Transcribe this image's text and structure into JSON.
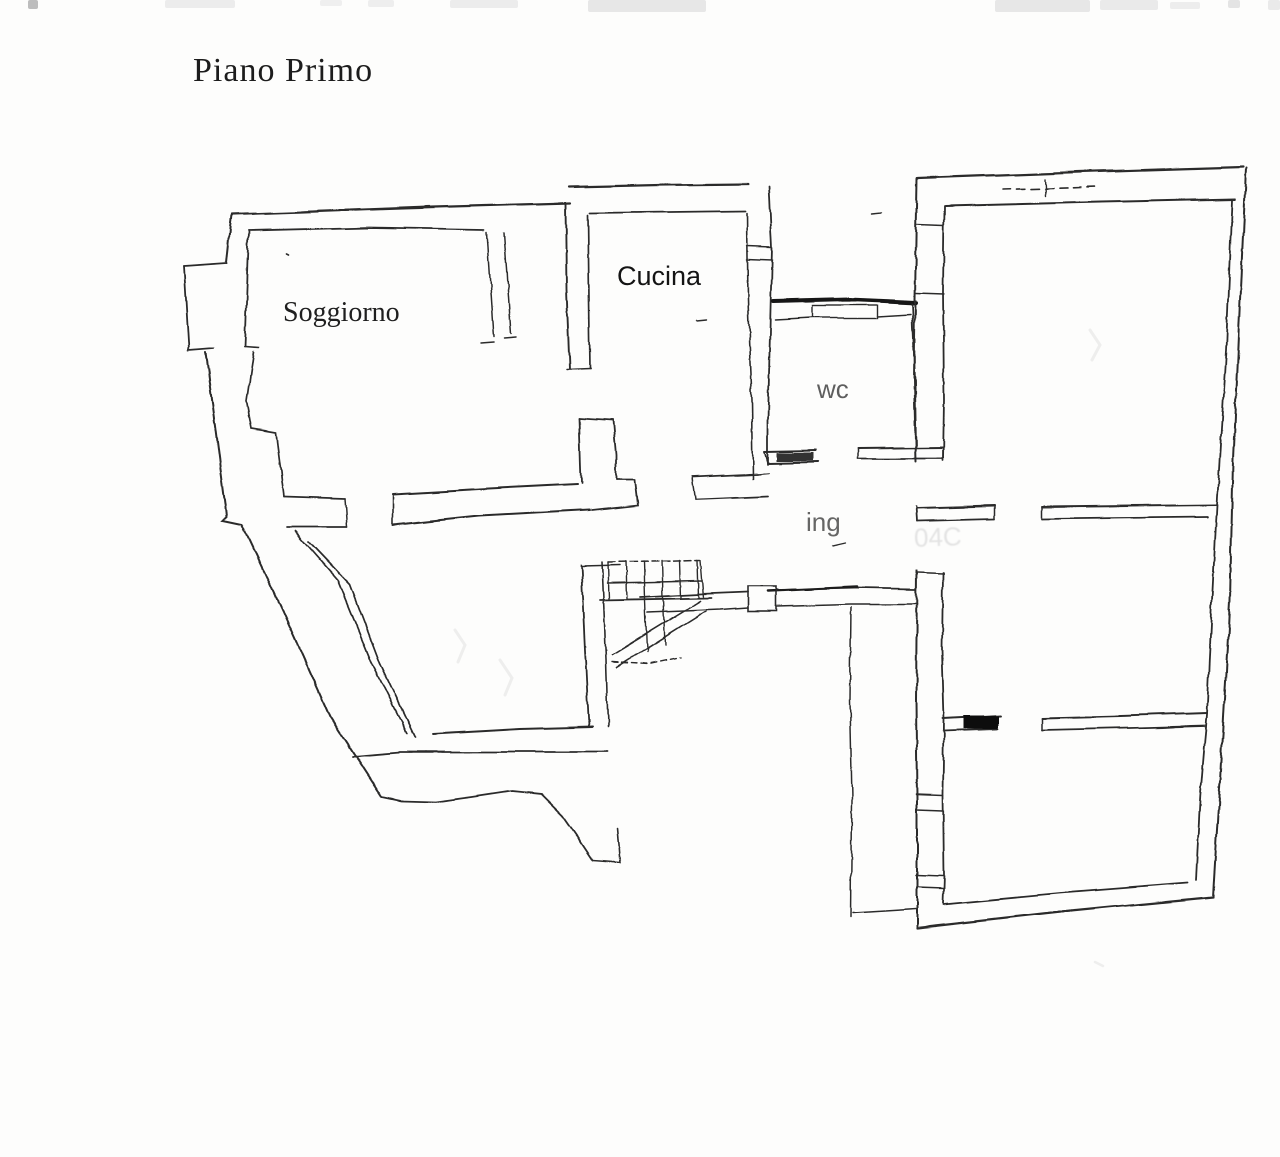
{
  "title": {
    "text": "Piano Primo",
    "x": 193,
    "y": 52,
    "size": 34,
    "color": "#1c1c1c"
  },
  "labels": {
    "soggiorno": {
      "text": "Soggiorno",
      "x": 283,
      "y": 299,
      "size": 28,
      "kind": "serif",
      "color": "#1f1f1f",
      "faded": false
    },
    "cucina": {
      "text": "Cucina",
      "x": 617,
      "y": 263,
      "size": 27,
      "kind": "sans",
      "color": "#141414",
      "faded": false
    },
    "wc": {
      "text": "wc",
      "x": 817,
      "y": 376,
      "size": 26,
      "kind": "sans",
      "color": "#3c3c3c",
      "faded": true
    },
    "ing": {
      "text": "ing",
      "x": 806,
      "y": 509,
      "size": 26,
      "kind": "sans",
      "color": "#454545",
      "faded": true
    }
  },
  "ghost_text": {
    "text": "04C",
    "x": 914,
    "y": 522,
    "size": 26
  },
  "floorplan": {
    "stroke": "#2c2c2c",
    "paths": [
      {
        "p": "232,214 400,208 570,203",
        "w": 2.2
      },
      {
        "p": "300,211 430,206",
        "w": 1.2
      },
      {
        "p": "232,214 227,263",
        "w": 2
      },
      {
        "p": "227,263 184,266",
        "w": 1.8
      },
      {
        "p": "184,266 189,350",
        "w": 1.8
      },
      {
        "p": "189,350 214,348",
        "w": 1.8
      },
      {
        "p": "206,352 227,516 223,520 242,524 283,612 330,717 382,797",
        "w": 2
      },
      {
        "p": "382,797 401,801 435,802 472,797 512,791 541,794 563,816 579,839 593,860",
        "w": 1.8
      },
      {
        "p": "593,860 620,862 617,828",
        "w": 1.6
      },
      {
        "p": "249,231 370,228 484,230",
        "w": 1.8
      },
      {
        "p": "249,231 245,347",
        "w": 1.8
      },
      {
        "p": "245,347 259,348",
        "w": 1.6
      },
      {
        "p": "254,352 247,401 252,429 276,433 284,496",
        "w": 1.7
      },
      {
        "p": "284,496 345,498",
        "w": 1.7
      },
      {
        "p": "286,527 347,527",
        "w": 1.7
      },
      {
        "p": "345,498 347,527",
        "w": 1.5
      },
      {
        "p": "295,531 338,580 371,661 407,733",
        "w": 1.7
      },
      {
        "p": "309,541 350,584 380,663 415,737",
        "w": 1.7
      },
      {
        "p": "433,734 520,729 593,727",
        "w": 1.9
      },
      {
        "p": "352,756 400,752 500,752 608,752",
        "w": 1.8
      },
      {
        "p": "393,494 480,489 577,484",
        "w": 2
      },
      {
        "p": "393,525 480,516 590,510",
        "w": 2
      },
      {
        "p": "393,494 393,525",
        "w": 1.6
      },
      {
        "p": "487,232 494,337",
        "w": 1.5
      },
      {
        "p": "504,232 511,334",
        "w": 1.5
      },
      {
        "p": "481,344 494,343",
        "w": 1.5
      },
      {
        "p": "504,339 516,338",
        "w": 1.5
      },
      {
        "p": "579,418 581,483",
        "w": 1.8
      },
      {
        "p": "579,418 613,420",
        "w": 1.8
      },
      {
        "p": "613,420 616,455 616,480",
        "w": 1.8
      },
      {
        "p": "616,480 634,480 637,505 592,510",
        "w": 1.8
      },
      {
        "p": "566,203 567,290 570,369",
        "w": 1.9
      },
      {
        "p": "588,215 589,300 590,368",
        "w": 1.7
      },
      {
        "p": "567,369 590,368",
        "w": 1.5
      },
      {
        "p": "568,187 660,185 748,184",
        "w": 2.2
      },
      {
        "p": "590,213 670,212 746,211",
        "w": 1.8
      },
      {
        "p": "769,186 772,247 770,330 768,420 768,464",
        "w": 1.8
      },
      {
        "p": "747,213 748,300 752,400 753,478",
        "w": 1.6
      },
      {
        "p": "747,246 772,247",
        "w": 1.5
      },
      {
        "p": "747,259 772,260",
        "w": 1.5
      },
      {
        "p": "692,477 757,474",
        "w": 1.8
      },
      {
        "p": "695,500 768,497",
        "w": 1.8
      },
      {
        "p": "692,477 695,500",
        "w": 1.5
      },
      {
        "p": "757,474 768,473",
        "w": 1.5
      },
      {
        "p": "773,301 850,299 916,302",
        "w": 4,
        "c": "#161616"
      },
      {
        "p": "775,320 812,318",
        "w": 1.5
      },
      {
        "p": "877,316 910,314",
        "w": 1.5
      },
      {
        "p": "912,303 915,380 916,448",
        "w": 1.8
      },
      {
        "p": "765,452 815,451",
        "w": 2
      },
      {
        "p": "768,463 818,462",
        "w": 2
      },
      {
        "p": "765,452 768,463",
        "w": 1.5
      },
      {
        "p": "858,448 943,447",
        "w": 2
      },
      {
        "p": "858,459 943,459",
        "w": 1.8
      },
      {
        "p": "858,448 858,459",
        "w": 1.5
      },
      {
        "p": "943,447 943,459",
        "w": 1.5
      },
      {
        "p": "640,597 700,594 748,592",
        "w": 1.8
      },
      {
        "p": "776,590 858,588 916,589",
        "w": 1.8
      },
      {
        "p": "648,612 720,609 748,607",
        "w": 1.6
      },
      {
        "p": "776,606 850,604 917,604",
        "w": 1.6
      },
      {
        "p": "768,591 856,587",
        "w": 2.6,
        "c": "#1d1d1d"
      },
      {
        "p": "608,562 700,560",
        "w": 1.5,
        "d": "7,4"
      },
      {
        "p": "608,583 702,581",
        "w": 1.5
      },
      {
        "p": "600,600 712,598",
        "w": 1.8
      },
      {
        "p": "626,561 627,599",
        "w": 1.4
      },
      {
        "p": "644,561 645,599",
        "w": 1.4
      },
      {
        "p": "662,560 663,598",
        "w": 1.4
      },
      {
        "p": "680,560 681,598",
        "w": 1.4
      },
      {
        "p": "698,560 699,598",
        "w": 1.4
      },
      {
        "p": "608,562 609,599",
        "w": 1.4
      },
      {
        "p": "701,560 704,598",
        "w": 1.4
      },
      {
        "p": "645,600 647,652",
        "w": 1.4
      },
      {
        "p": "663,599 665,645",
        "w": 1.4
      },
      {
        "p": "612,655 700,601",
        "w": 1.6
      },
      {
        "p": "617,667 706,611",
        "w": 1.6
      },
      {
        "p": "612,662 650,664 682,657",
        "w": 1.4,
        "d": "6,4"
      },
      {
        "p": "581,565 585,650 589,727",
        "w": 1.8
      },
      {
        "p": "602,562 606,660 608,726",
        "w": 1.6
      },
      {
        "p": "582,566 620,565",
        "w": 1.5
      },
      {
        "p": "918,178 1080,172 1243,167",
        "w": 2.2
      },
      {
        "p": "945,206 1100,202 1235,199",
        "w": 2
      },
      {
        "p": "917,178 915,300 914,380 916,462",
        "w": 2
      },
      {
        "p": "916,506 917,521",
        "w": 1.8
      },
      {
        "p": "917,571 916,700 917,800 917,928",
        "w": 2
      },
      {
        "p": "944,206 943,292 944,400 943,461",
        "w": 1.8
      },
      {
        "p": "917,225 944,226",
        "w": 1.5
      },
      {
        "p": "916,293 944,294",
        "w": 1.5
      },
      {
        "p": "1003,190 1097,187",
        "w": 1.6,
        "d": "8,6"
      },
      {
        "p": "1045,179 1046,196",
        "w": 1.4
      },
      {
        "p": "1232,200 1226,350 1217,505 1212,600 1207,715 1200,800 1196,880",
        "w": 1.8
      },
      {
        "p": "1246,168 1240,300 1233,460 1230,600 1220,780 1213,897",
        "w": 2
      },
      {
        "p": "917,508 995,506",
        "w": 1.9
      },
      {
        "p": "917,521 995,519",
        "w": 1.7
      },
      {
        "p": "995,506 995,519",
        "w": 1.5
      },
      {
        "p": "1042,507 1130,506 1216,505",
        "w": 1.9
      },
      {
        "p": "1042,519 1120,518 1208,517",
        "w": 1.7
      },
      {
        "p": "1042,507 1042,519",
        "w": 1.5
      },
      {
        "p": "851,607 850,700 852,800 851,917",
        "w": 1.5
      },
      {
        "p": "853,913 916,909",
        "w": 1.5
      },
      {
        "p": "943,573 942,650 944,720 943,795 944,875 943,903",
        "w": 1.8
      },
      {
        "p": "918,573 943,574",
        "w": 1.6
      },
      {
        "p": "916,795 943,796",
        "w": 1.5
      },
      {
        "p": "917,810 943,811",
        "w": 1.5
      },
      {
        "p": "916,875 943,876",
        "w": 1.5
      },
      {
        "p": "917,887 943,888",
        "w": 1.5
      },
      {
        "p": "943,719 1000,716",
        "w": 1.9
      },
      {
        "p": "943,731 998,729",
        "w": 1.7
      },
      {
        "p": "1042,718 1120,716 1207,713",
        "w": 1.9
      },
      {
        "p": "1042,730 1130,728 1205,726",
        "w": 1.7
      },
      {
        "p": "1042,718 1042,730",
        "w": 1.5
      },
      {
        "p": "917,928 1060,912 1213,897",
        "w": 2.2
      },
      {
        "p": "943,904 1060,893 1188,883",
        "w": 1.8
      },
      {
        "p": "872,214 882,213",
        "w": 1.4
      },
      {
        "p": "697,321 707,320",
        "w": 1.4
      },
      {
        "p": "287,254 289,255",
        "w": 1.6
      },
      {
        "p": "832,546 845,543",
        "w": 1.3
      }
    ],
    "rects": [
      {
        "x": 813,
        "y": 305,
        "w": 64,
        "h": 13,
        "sw": 1.4
      },
      {
        "x": 748,
        "y": 586,
        "w": 28,
        "h": 24,
        "sw": 1.6
      },
      {
        "x": 777,
        "y": 453,
        "w": 36,
        "h": 8,
        "f": "#333333"
      },
      {
        "x": 963,
        "y": 716,
        "w": 35,
        "h": 13,
        "f": "#101010"
      }
    ]
  },
  "ghost_marks": [
    {
      "p": "455,630 465,645 458,662",
      "w": 3
    },
    {
      "p": "500,660 512,678 505,695",
      "w": 3
    },
    {
      "p": "1090,330 1100,345 1092,360",
      "w": 3
    },
    {
      "p": "1095,962 1103,966",
      "w": 2.5
    }
  ],
  "scan_noise": [
    {
      "x": 28,
      "y": 0,
      "w": 10,
      "h": 9,
      "c": "#bdbdbd"
    },
    {
      "x": 165,
      "y": 0,
      "w": 70,
      "h": 8,
      "c": "#ececec"
    },
    {
      "x": 320,
      "y": 0,
      "w": 22,
      "h": 6,
      "c": "#efefef"
    },
    {
      "x": 368,
      "y": 0,
      "w": 26,
      "h": 7,
      "c": "#eeeeee"
    },
    {
      "x": 450,
      "y": 0,
      "w": 68,
      "h": 8,
      "c": "#ececec"
    },
    {
      "x": 588,
      "y": 0,
      "w": 118,
      "h": 12,
      "c": "#e7e7e7"
    },
    {
      "x": 995,
      "y": 0,
      "w": 95,
      "h": 12,
      "c": "#e7e7e7"
    },
    {
      "x": 1100,
      "y": 0,
      "w": 58,
      "h": 10,
      "c": "#eaeaea"
    },
    {
      "x": 1170,
      "y": 2,
      "w": 30,
      "h": 7,
      "c": "#ededed"
    },
    {
      "x": 1228,
      "y": 0,
      "w": 12,
      "h": 8,
      "c": "#e4e4e4"
    },
    {
      "x": 1268,
      "y": 0,
      "w": 12,
      "h": 10,
      "c": "#eaeaea"
    }
  ]
}
